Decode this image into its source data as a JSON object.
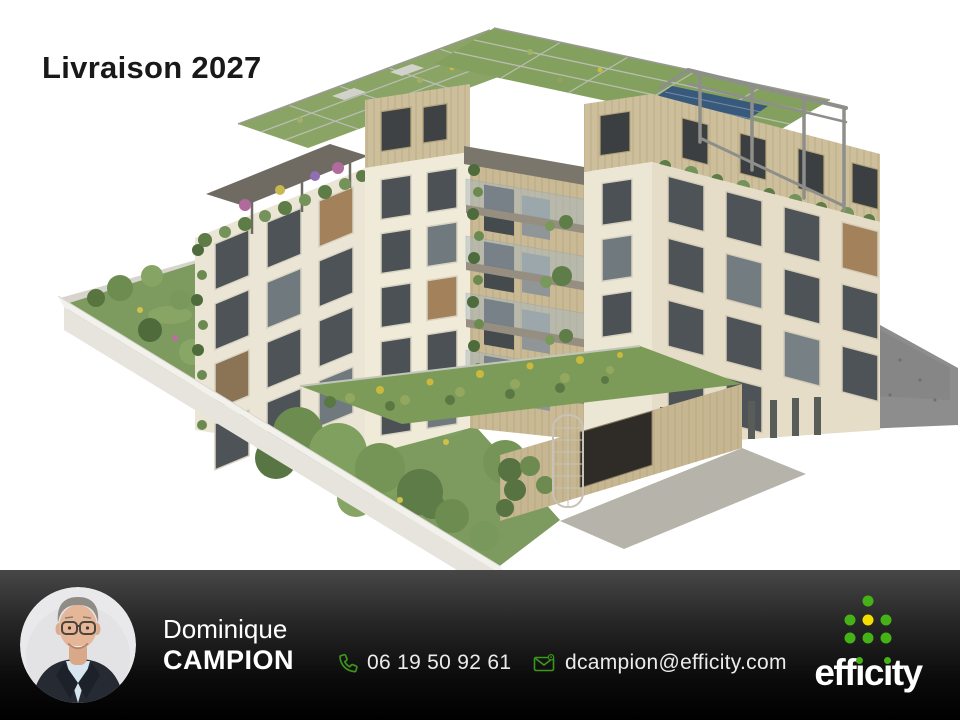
{
  "page": {
    "type": "real-estate promotional visual",
    "background": "#ffffff"
  },
  "header": {
    "title": "Livraison 2027",
    "title_color": "#191919"
  },
  "illustration": {
    "alt": "Aerial 3D rendering of a new cream apartment residence with wood-clad top floor, planted rooftops with pergolas and solar panels, balconies with hanging greenery, a landscaped courtyard garden, white perimeter wall and grey pavement",
    "palette": {
      "facade": "#ebe5d6",
      "facade_shaded": "#e6ddc9",
      "wood_cladding": "#cdbf9c",
      "roof_green": "#84a05f",
      "garden_green": "#7d9a5f",
      "solar_panel": "#38597c",
      "pavement": "#8d8d8d",
      "wall_white": "#f2f1ec"
    }
  },
  "footer": {
    "background": {
      "top": "#474747",
      "bottom": "#000000"
    },
    "agent": {
      "first_name": "Dominique",
      "last_name": "CAMPION",
      "photo_alt": "smiling man with glasses wearing a dark suit and light blue shirt"
    },
    "contact": {
      "phone": "06 19 50 92 61",
      "email": "dcampion@efficity.com",
      "icon_color": "#3c961b"
    },
    "logo": {
      "brand": "efficity",
      "word_parts": {
        "p1": "eff",
        "i1": "ı",
        "p2": "c",
        "i2": "ı",
        "p3": "ty"
      },
      "dot_green": "#45b317",
      "dot_yellow": "#f2df00",
      "text_color": "#ffffff"
    }
  }
}
